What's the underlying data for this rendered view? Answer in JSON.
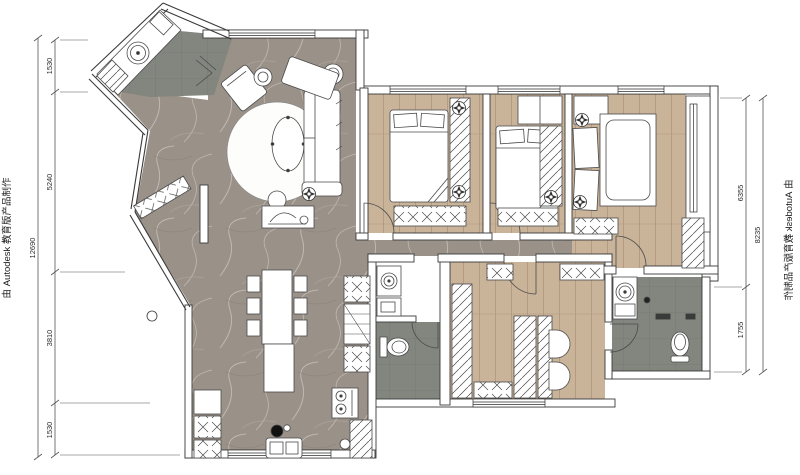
{
  "title": "apartment-floor-plan",
  "watermark": {
    "left": "由 Autodesk 教育版产品制作",
    "right": "由 Autodesk 教育版产品制作"
  },
  "dimensions": {
    "left": {
      "overall": "12690",
      "segments": [
        "1530",
        "5240",
        "3810",
        "1530"
      ]
    },
    "right": {
      "overall": "8235",
      "segments": [
        "6355",
        "1755"
      ]
    }
  },
  "colors": {
    "marble_floor": "#9a9189",
    "wood_floor": "#c9b399",
    "tile_floor": "#82867e",
    "wall_line": "#3a3a3a",
    "dim_line": "#555555",
    "paper": "#ffffff"
  },
  "icons": {
    "ceiling_light": "circle-with-4-point-star",
    "door_swing": "quarter-arc",
    "wardrobe_fill": "diagonal-hatch",
    "bench_fill": "cross-hatch"
  }
}
